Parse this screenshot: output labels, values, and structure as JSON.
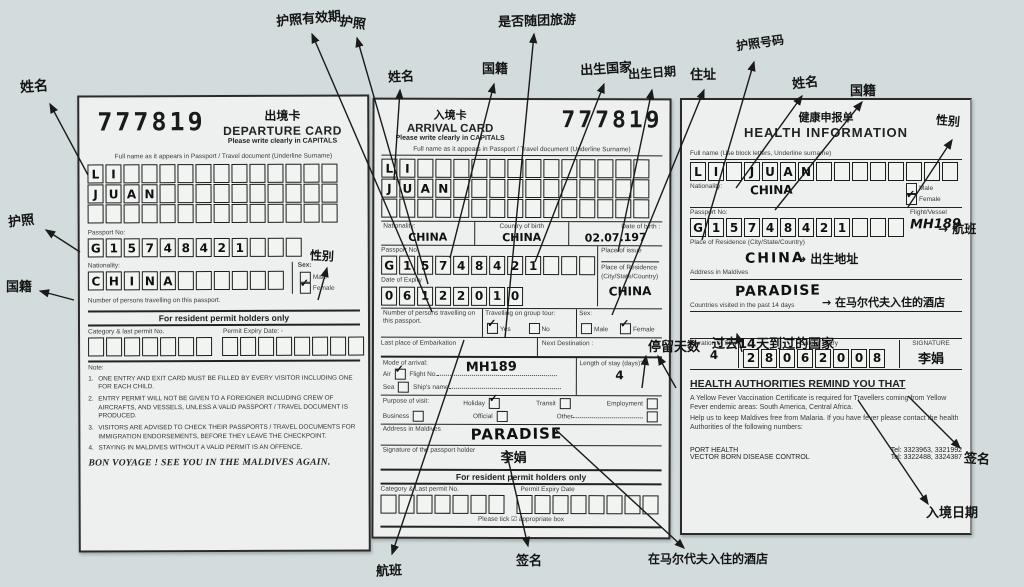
{
  "empty": "",
  "departure_card": {
    "serial": "777819",
    "title_cn": "出境卡",
    "title": "DEPARTURE CARD",
    "subtitle": "Please write clearly in CAPITALS",
    "full_name_label": "Full name as it appears in Passport / Travel document (Underline Surname)",
    "name_line1": "LI",
    "name_line2": "JUAN",
    "passport_no_label": "Passport No:",
    "passport_no": "G15748421",
    "nationality_label": "Nationality:",
    "nationality": "CHINA",
    "sex_label": "Sex:",
    "male_label": "Male",
    "female_label": "Female",
    "male_check": "",
    "female_check": "✓",
    "persons_label": "Number of persons travelling on this passport.",
    "resident_header": "For resident permit holders only",
    "category_label": "Category & last permit No.",
    "permit_expiry_label": "Permit Expiry Date: -",
    "note_label": "Note:",
    "notes": [
      "ONE ENTRY AND EXIT CARD MUST BE  FILLED BY EVERY VISITOR INCLUDING ONE FOR EACH CHILD.",
      "ENTRY PERMIT WILL NOT BE GIVEN TO A FOREIGNER INCLUDING CREW OF AIRCRAFTS, AND VESSELS, UNLESS A VALID PASSPORT / TRAVEL DOCUMENT IS PRODUCED.",
      "VISITORS ARE ADVISED TO CHECK THEIR PASSPORTS / TRAVEL DOCUMENTS FOR IMMIGRATION ENDORSEMENTS, BEFORE THEY LEAVE THE CHECKPOINT.",
      "STAYING IN MALDIVES WITHOUT A VALID PERMIT IS AN OFFENCE."
    ],
    "farewell": "BON VOYAGE !  SEE YOU IN THE MALDIVES AGAIN."
  },
  "arrival_card": {
    "serial": "777819",
    "title_cn": "入境卡",
    "title": "ARRIVAL CARD",
    "subtitle": "Please write clearly in CAPITALS",
    "full_name_label": "Full name as it appears in Passport / Travel document (Underline Surname)",
    "name_line1": "LI",
    "name_line2": "JUAN",
    "nationality_label": "Nationality:",
    "nationality": "CHINA",
    "country_of_birth_label": "Country of birth",
    "country_of_birth": "CHINA",
    "date_of_birth_label": "Date of birth :",
    "date_of_birth": "02.07.197",
    "passport_no_label": "Passport No:",
    "passport_no": "G15748421",
    "place_of_issue_label": "Place of issue",
    "date_of_expiry_label": "Date of Expiry",
    "date_of_expiry": "06122010",
    "residence_label": "Place of Residence (City/State/Country)",
    "residence": "CHINA",
    "persons_label": "Number of persons travelling on this passport.",
    "group_tour_label": "Travelling on group tour:",
    "yes_label": "Yes",
    "no_label": "No",
    "yes_check": "✓",
    "no_check": "",
    "sex_label": "Sex:",
    "male_label": "Male",
    "female_label": "Female",
    "male_check": "",
    "female_check": "✓",
    "embarkation_label": "Last place of Embarkation",
    "next_destination_label": "Next Destination :",
    "mode_label": "Mode of arrival:",
    "air_label": "Air",
    "air_check": "✓",
    "flight_no_label": "Flight No.",
    "flight_no": "MH189",
    "sea_label": "Sea",
    "sea_check": "",
    "ship_label": "Ship's name",
    "stay_label": "Length of stay (days)?",
    "stay_value": "4",
    "purpose_label": "Purpose of visit:",
    "holiday_label": "Holiday",
    "holiday_check": "✓",
    "transit_label": "Transit",
    "transit_check": "",
    "employment_label": "Employment",
    "employment_check": "",
    "business_label": "Business",
    "business_check": "",
    "official_label": "Official",
    "official_check": "",
    "other_label": "Other",
    "other_check": "",
    "address_label": "Address in Maldives",
    "address_value": "PARADISE",
    "signature_label": "Signature of the passport holder",
    "signature_value": "李娟",
    "resident_header": "For resident permit holders only",
    "category_label": "Category & Last permit No.",
    "permit_expiry_label": "Permit Expiry Date",
    "tick_note": "Please tick ☑  appropriate box"
  },
  "health_card": {
    "title_cn": "健康申报单",
    "title": "HEALTH INFORMATION",
    "full_name_label": "Full name (Use block letters, Underline surname)",
    "full_name": "LI JUAN",
    "nationality_label": "Nationality:",
    "nationality": "CHINA",
    "male_label": "Male",
    "female_label": "Female",
    "male_check": "",
    "female_check": "✓",
    "passport_no_label": "Passport No:",
    "passport_no": "G15748421",
    "flight_label": "Flight/Vessel",
    "flight_value": "MH189",
    "residence_label": "Place of Residence (City/State/Country)",
    "residence": "CHINA",
    "address_label": "Address in Maldives",
    "address_value": "PARADISE",
    "countries_label": "Countries visited in the past 14 days",
    "duration_label": "Duration of Stay",
    "duration_value": "4",
    "entry_date_label": "Date of Entry",
    "entry_date": "28062008",
    "signature_label": "SIGNATURE",
    "signature_value": "李娟",
    "remind_title": "HEALTH AUTHORITIES REMIND YOU THAT",
    "remind_p1": "A Yellow Fever Vaccination Certificate is required for Travellers coming from Yellow Fever endemic areas: South America, Central Africa.",
    "remind_p2": "Help us to keep Maldives free from Malaria. If you have fever please contact the health Authorities of the following numbers:",
    "port_health": "PORT HEALTH",
    "vector_control": "VECTOR BORN DISEASE CONTROL",
    "tel1": "Tel: 3323963, 3321992",
    "tel2": "Tel: 3322488, 3324387"
  },
  "annotations": {
    "name_dep": "姓名",
    "passport_dep": "护照",
    "nationality_dep": "国籍",
    "sex_dep": "性别",
    "passport_expiry": "护照有效期",
    "passport_top": "护照",
    "name_arr": "姓名",
    "nationality_arr": "国籍",
    "group_tour": "是否随团旅游",
    "birth_country": "出生国家",
    "birth_date": "出生日期",
    "address": "住址",
    "passport_no": "护照号码",
    "name_health": "姓名",
    "nationality_health": "国籍",
    "sex_health": "性别",
    "stay_days": "停留天数",
    "countries_14": "过去14天到过的国家",
    "flight_arrow": "→ 航班",
    "birth_addr_arrow": "→ 出生地址",
    "hotel_arrow": "→ 在马尔代夫入住的酒店",
    "sign_right": "签名",
    "entry_date": "入境日期",
    "flight_bottom": "航班",
    "sign_bottom": "签名",
    "hotel_bottom": "在马尔代夫入住的酒店"
  }
}
